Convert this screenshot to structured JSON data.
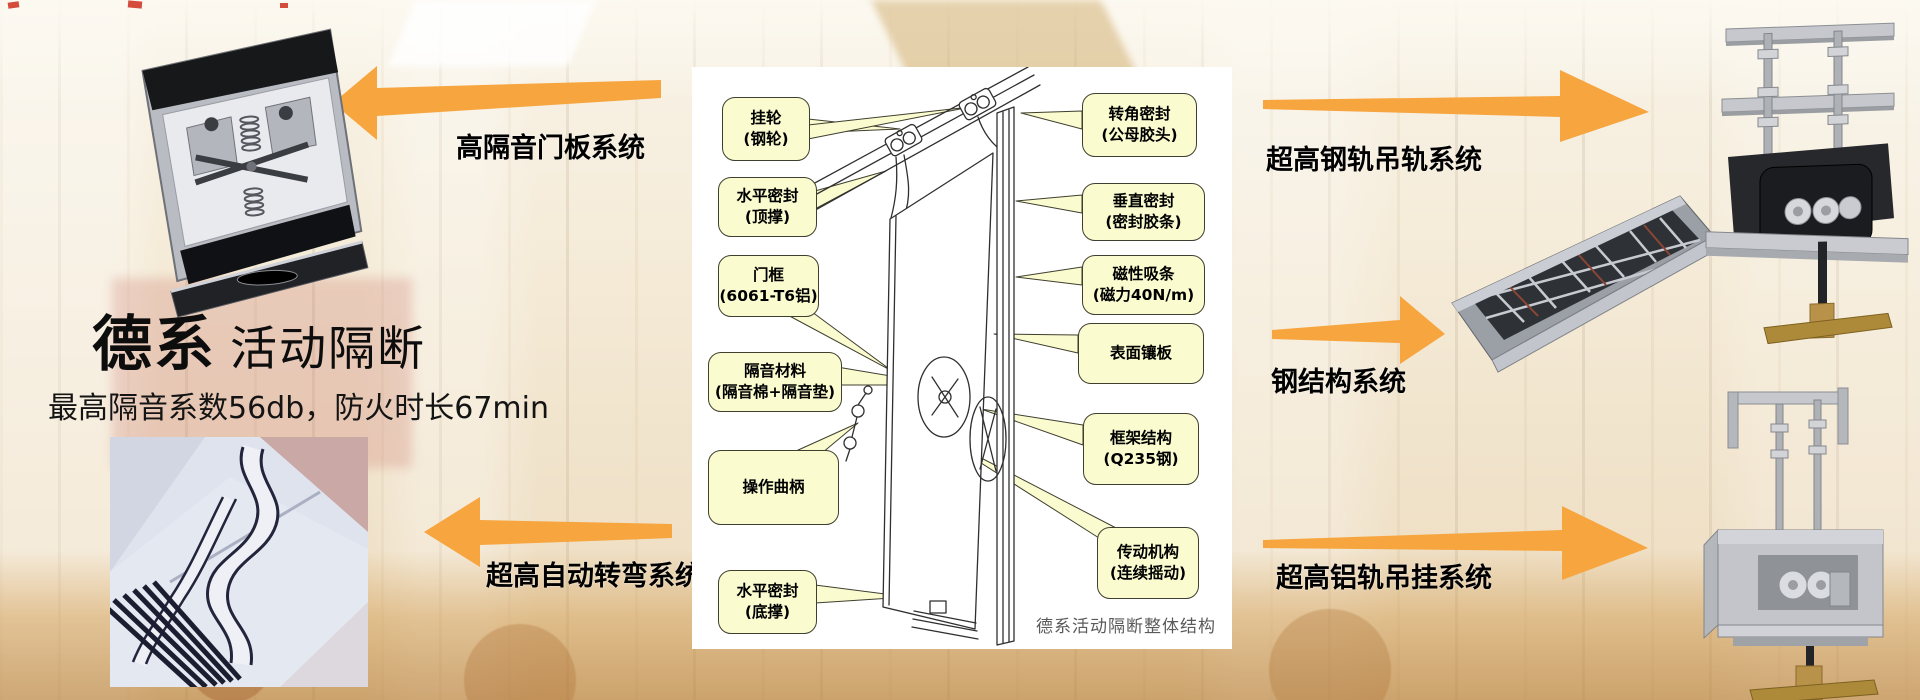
{
  "slide": {
    "title_bold": "德系",
    "title_light": "活动隔断",
    "subtitle": "最高隔音系数56db，防火时长67min"
  },
  "labels": {
    "left_top": "高隔音门板系统",
    "left_bottom": "超高自动转弯系统",
    "right_top": "超高钢轨吊轨系统",
    "right_middle": "钢结构系统",
    "right_bottom": "超高铝轨吊挂系统"
  },
  "diagram": {
    "caption": "德系活动隔断整体结构",
    "callouts_left": [
      {
        "line1": "挂轮",
        "line2": "(钢轮)"
      },
      {
        "line1": "水平密封",
        "line2": "(顶撑)"
      },
      {
        "line1": "门框",
        "line2": "(6061-T6铝)"
      },
      {
        "line1": "隔音材料",
        "line2": "(隔音棉+隔音垫)"
      },
      {
        "line1": "操作曲柄",
        "line2": ""
      },
      {
        "line1": "水平密封",
        "line2": "(底撑)"
      }
    ],
    "callouts_right": [
      {
        "line1": "转角密封",
        "line2": "(公母胶头)"
      },
      {
        "line1": "垂直密封",
        "line2": "(密封胶条)"
      },
      {
        "line1": "磁性吸条",
        "line2": "(磁力40N/m)"
      },
      {
        "line1": "表面镶板",
        "line2": ""
      },
      {
        "line1": "框架结构",
        "line2": "(Q235钢)"
      },
      {
        "line1": "传动机构",
        "line2": "(连续摇动)"
      }
    ]
  },
  "photos": {
    "door_panel_mechanism": "door-panel-top-mechanism-photo",
    "curved_track": "curved-track-system-photo",
    "steel_structure": "steel-structure-photo",
    "steel_rail_hanger": "steel-rail-hanger-photo",
    "aluminum_rail_hanger": "aluminum-rail-hanger-photo"
  },
  "colors": {
    "arrow_orange": "#F7A53F",
    "callout_bg": "#FBFBD0",
    "callout_border": "#3F3F2F",
    "caption_gray": "#5A5A5A"
  }
}
